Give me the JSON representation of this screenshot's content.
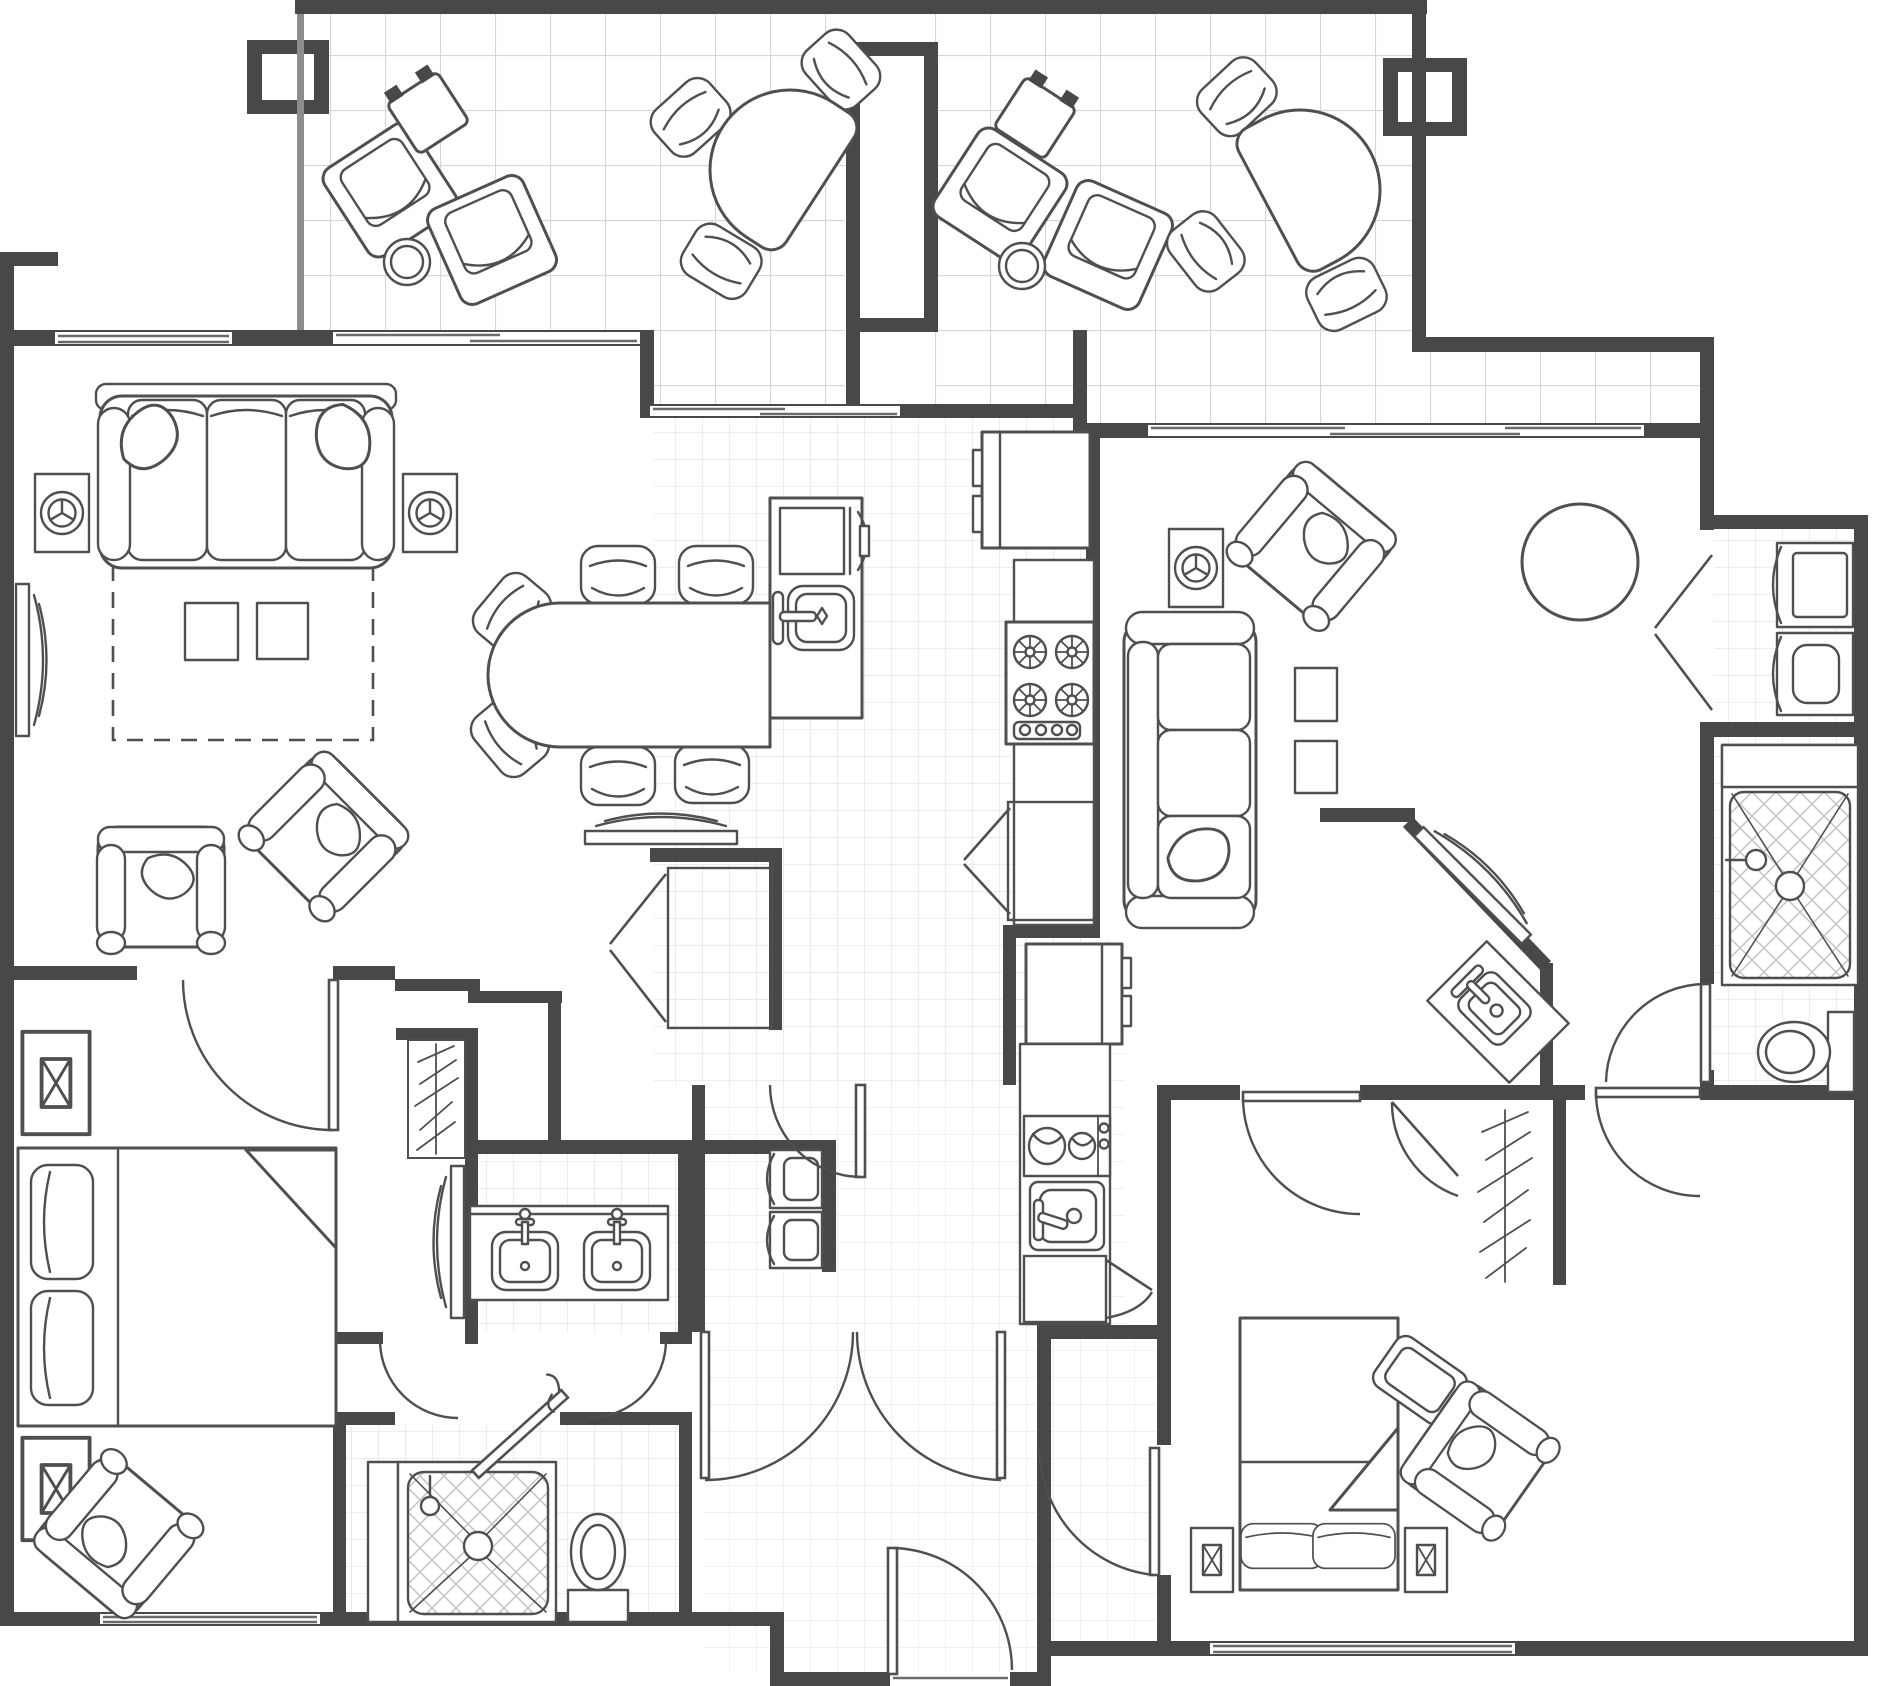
{
  "document": {
    "kind": "architectural-floor-plan",
    "description": "Two-unit lock-off condominium floor plan, top-down, monochrome line drawing with two tiled balconies, living/dining room, galley kitchen, two bedrooms, three bathrooms, laundry closets and entry vestibule",
    "text_labels": []
  },
  "palette": {
    "paper": "#ffffff",
    "wall": "#484848",
    "ink": "#4f4f4f",
    "tileL": "#d6d6d6",
    "tileS": "#e7e7e7",
    "hatch": "#c6c6c6"
  },
  "rooms": [
    {
      "id": "balcony-left",
      "floor": "large-tile",
      "furniture": [
        "lounge-chair",
        "lounge-chair",
        "patio-side-table",
        "round-table",
        "patio-dining-table",
        "patio-chair",
        "patio-chair",
        "patio-chair"
      ]
    },
    {
      "id": "balcony-right",
      "floor": "large-tile",
      "furniture": [
        "lounge-chair",
        "lounge-chair",
        "patio-side-table",
        "round-table",
        "patio-dining-table",
        "patio-chair",
        "patio-chair",
        "patio-chair"
      ]
    },
    {
      "id": "living-room",
      "floor": "plain",
      "furniture": [
        "sofa-3-seat",
        "speaker-end-table",
        "speaker-end-table",
        "area-rug-dashed",
        "coffee-table",
        "coffee-table",
        "tv-on-west-wall",
        "armchair",
        "angled-armchair"
      ]
    },
    {
      "id": "dining-area",
      "floor": "plain",
      "furniture": [
        "oval-dining-table",
        "dining-chair-x6",
        "tv-console-north"
      ]
    },
    {
      "id": "kitchen-main",
      "floor": "small-tile",
      "furniture": [
        "island-with-oven-and-sink",
        "refrigerator",
        "cooktop-4-burner",
        "counter",
        "bifold-pantry"
      ]
    },
    {
      "id": "bedroom-1",
      "floor": "plain",
      "furniture": [
        "king-bed",
        "nightstand-x2",
        "armchair",
        "built-in-closet-hanging-clothes",
        "tv-cabinet"
      ]
    },
    {
      "id": "master-bath",
      "floor": "small-tile",
      "furniture": [
        "double-vanity",
        "stacked-washer-dryer",
        "walk-in-shower",
        "toilet",
        "walk-in-closet-bifold"
      ]
    },
    {
      "id": "entry-vestibule",
      "floor": "small-tile",
      "furniture": [
        "entry-door",
        "double-doors"
      ]
    },
    {
      "id": "unit-b-living",
      "floor": "plain",
      "furniture": [
        "sofa-3-seat",
        "speaker-end-table",
        "armchair",
        "round-dining-table",
        "side-table",
        "side-table",
        "diagonal-tv-console"
      ]
    },
    {
      "id": "unit-b-kitchenette",
      "floor": "small-tile",
      "furniture": [
        "refrigerator",
        "cooktop-2-burner",
        "sink",
        "base-cabinet"
      ]
    },
    {
      "id": "unit-b-laundry",
      "floor": "small-tile",
      "furniture": [
        "washer",
        "dryer",
        "bifold-doors"
      ]
    },
    {
      "id": "unit-b-bath",
      "floor": "small-tile",
      "furniture": [
        "walk-in-shower",
        "toilet",
        "angled-vanity-sink"
      ]
    },
    {
      "id": "bedroom-2",
      "floor": "plain",
      "furniture": [
        "queen-bed",
        "nightstand-x2",
        "armchair",
        "ottoman",
        "closet-hanging-clothes"
      ]
    }
  ]
}
